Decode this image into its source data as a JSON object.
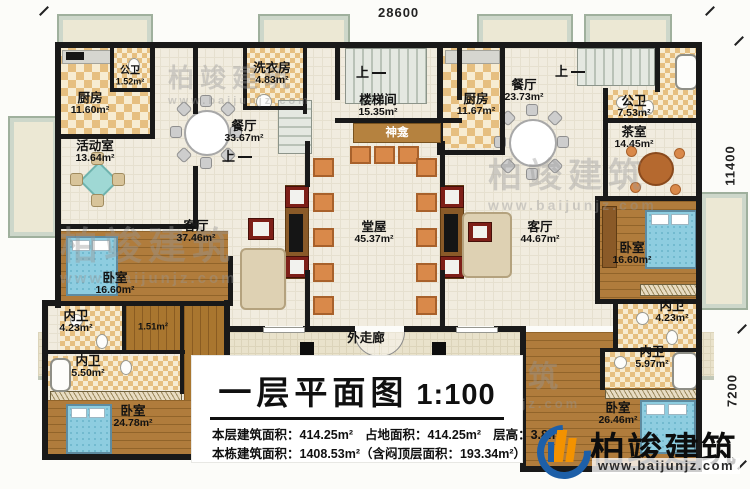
{
  "plan": {
    "title": "一层平面图",
    "scale": "1:100",
    "stats": {
      "floor_area_label": "本层建筑面积：",
      "floor_area": "414.25m²",
      "land_label": "占地面积：",
      "land_area": "414.25m²",
      "height_label": "层高：",
      "height": "3.8m",
      "total_label": "本栋建筑面积：",
      "total_area": "1408.53m²",
      "attic_note": "（含闷顶层面积：193.34m²）"
    }
  },
  "dimensions": {
    "top": "28600",
    "right_upper": "11400",
    "right_lower": "7200"
  },
  "stairs_up_label": "上",
  "rooms": {
    "kitchen_left": {
      "name": "厨房",
      "area": "11.60m²"
    },
    "bath_small_left": {
      "name": "公卫",
      "area": "1.52m²"
    },
    "laundry": {
      "name": "洗衣房",
      "area": "4.83m²"
    },
    "dining_left": {
      "name": "餐厅",
      "area": "33.67m²"
    },
    "activity": {
      "name": "活动室",
      "area": "13.64m²"
    },
    "stair_hall": {
      "name": "楼梯间",
      "area": "15.35m²"
    },
    "shrine": {
      "name": "神龛"
    },
    "kitchen_right": {
      "name": "厨房",
      "area": "11.67m²"
    },
    "dining_right": {
      "name": "餐厅",
      "area": "23.73m²"
    },
    "bath_public_right": {
      "name": "公卫",
      "area": "7.53m²"
    },
    "tea_room": {
      "name": "茶室",
      "area": "14.45m²"
    },
    "living_left": {
      "name": "客厅",
      "area": "37.46m²"
    },
    "main_hall": {
      "name": "堂屋",
      "area": "45.37m²"
    },
    "living_right": {
      "name": "客厅",
      "area": "44.67m²"
    },
    "bedroom_left_mid": {
      "name": "卧室",
      "area": "16.60m²"
    },
    "bedroom_right_mid": {
      "name": "卧室",
      "area": "16.60m²"
    },
    "ensuite_left_upper": {
      "name": "内卫",
      "area": "4.23m²"
    },
    "closet_left": {
      "area": "1.51m²"
    },
    "ensuite_left_lower": {
      "name": "内卫",
      "area": "5.50m²"
    },
    "bedroom_left_bottom": {
      "name": "卧室",
      "area": "24.78m²"
    },
    "ensuite_right_upper": {
      "name": "内卫",
      "area": "4.23m²"
    },
    "ensuite_right_lower": {
      "name": "内卫",
      "area": "5.97m²"
    },
    "bedroom_right_bottom": {
      "name": "卧室",
      "area": "26.46m²"
    },
    "corridor": {
      "name": "外走廊"
    }
  },
  "branding": {
    "logo_text": "柏竣建筑",
    "logo_url": "www.baijunjz.com",
    "watermark_text": "柏竣建筑",
    "watermark_url": "www.baijunjz.com"
  },
  "colors": {
    "wall": "#191919",
    "accent_band": "#b5823f",
    "logo_blue": "#1d5fa8",
    "logo_orange": "#f39200"
  }
}
